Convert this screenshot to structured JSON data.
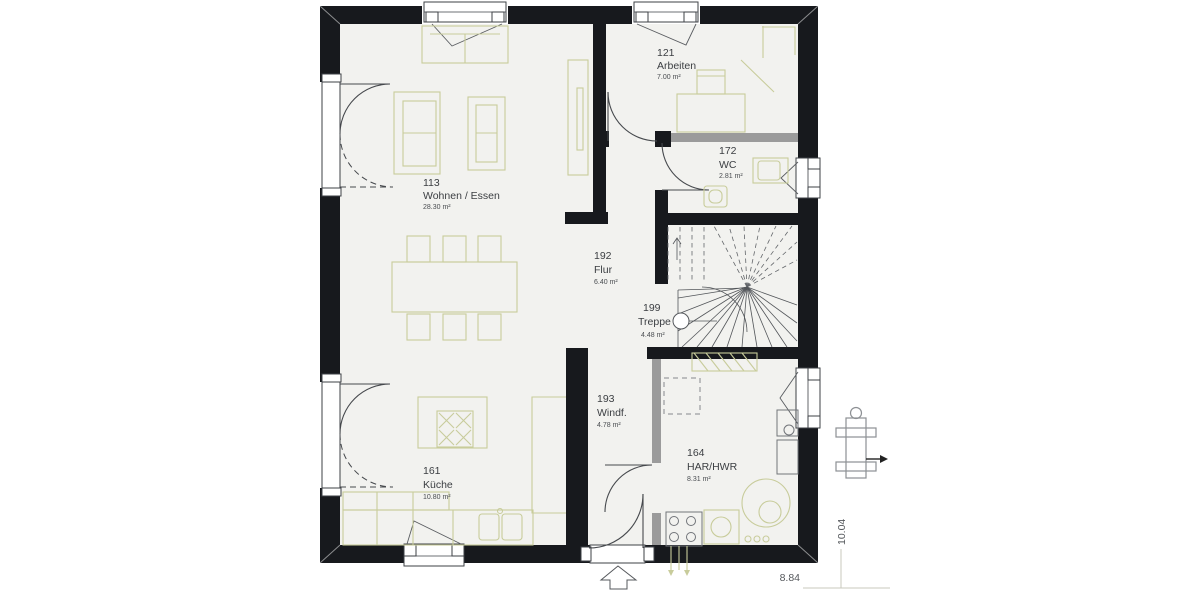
{
  "plan": {
    "title": "Erdgeschoss Grundriss",
    "rooms": [
      {
        "id": "113",
        "name": "Wohnen / Essen",
        "area": "28.30 m²"
      },
      {
        "id": "121",
        "name": "Arbeiten",
        "area": "7.00 m²"
      },
      {
        "id": "172",
        "name": "WC",
        "area": "2.81 m²"
      },
      {
        "id": "192",
        "name": "Flur",
        "area": "6.40 m²"
      },
      {
        "id": "199",
        "name": "Treppe",
        "area": "4.48 m²"
      },
      {
        "id": "193",
        "name": "Windf.",
        "area": "4.78 m²"
      },
      {
        "id": "161",
        "name": "Küche",
        "area": "10.80 m²"
      },
      {
        "id": "164",
        "name": "HAR/HWR",
        "area": "8.31 m²"
      }
    ],
    "dimensions": {
      "width": "8.84",
      "depth": "10.04"
    },
    "colors": {
      "wall": "#17191d",
      "floor": "#f2f2ef",
      "furniture": "#c8cc9b",
      "partition": "#9b9b9b"
    }
  }
}
